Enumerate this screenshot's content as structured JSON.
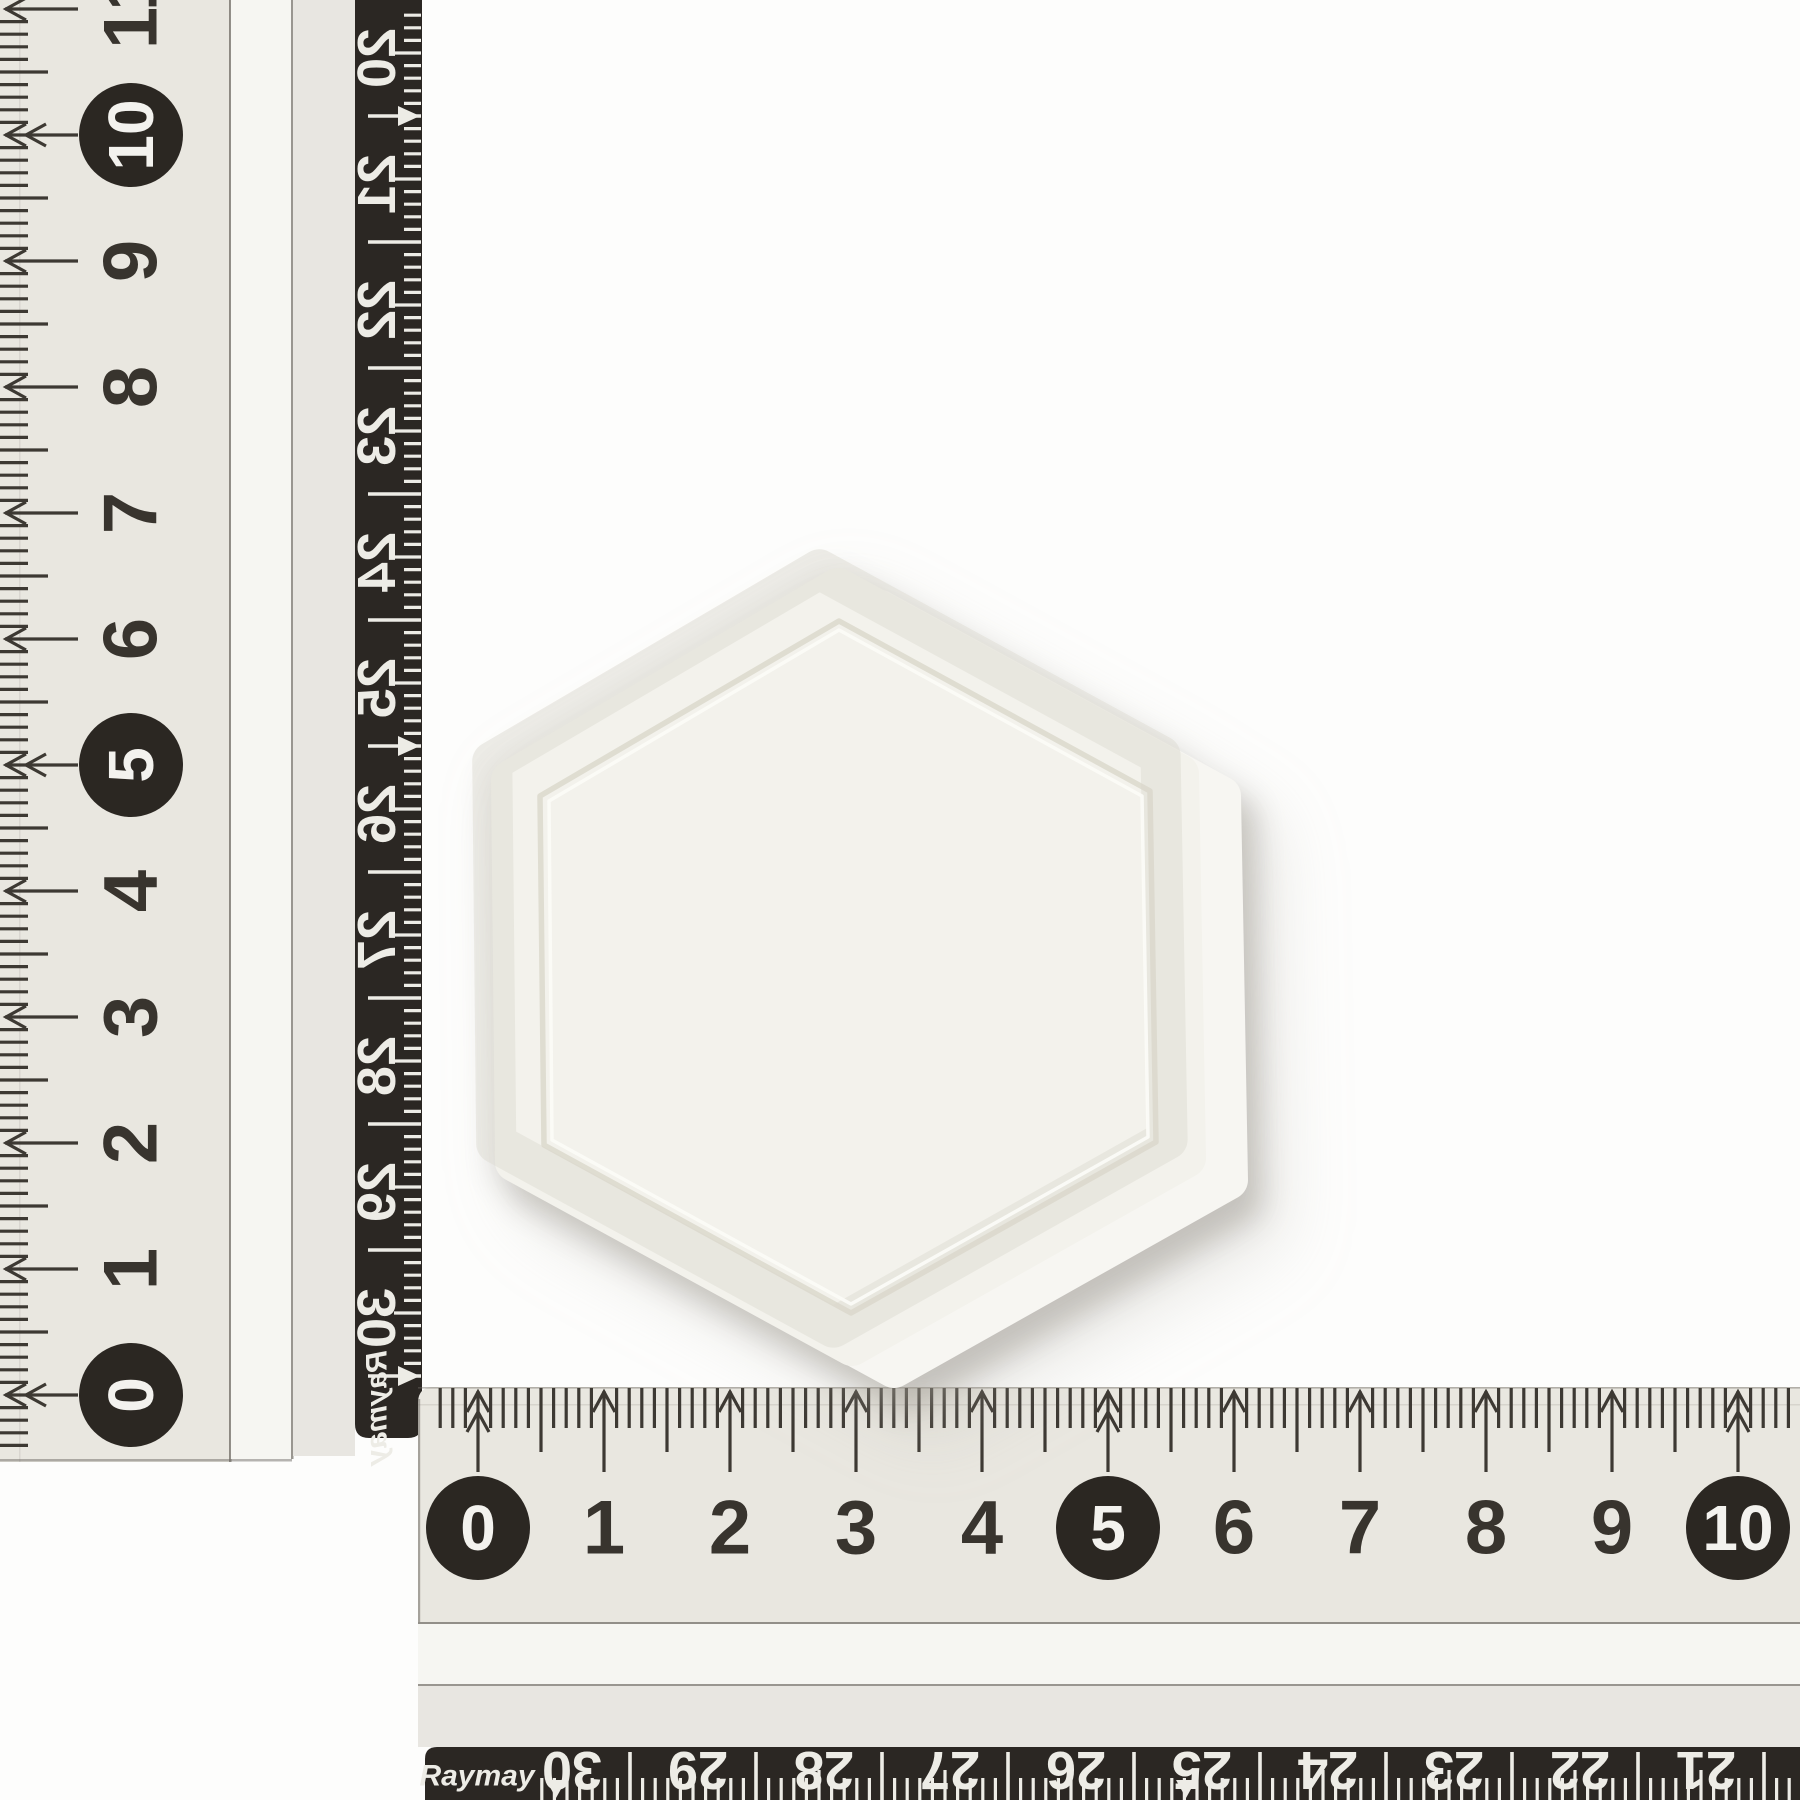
{
  "brand_label": "Raymay",
  "colors": {
    "background": "#fdfdfc",
    "ruler_face": "#e9e7e0",
    "ruler_bevel": "#f6f6f2",
    "ruler_gap": "#e8e6e1",
    "edge_line": "#6e6a63",
    "subtle_line": "#cfccc5",
    "tick": "#3d3933",
    "digit": "#38342e",
    "circle_fill": "#2b2722",
    "circle_digit": "#f3f2ee",
    "strip_fill": "#2b2723",
    "strip_mark": "#edece6",
    "hex_face": "#f3f2ec",
    "hex_side": "#f7f6f2",
    "groove": "#d9d7cb",
    "groove_highlight": "#fbfbf7"
  },
  "vertical_ruler": {
    "front_labels": [
      "0",
      "1",
      "2",
      "3",
      "4",
      "5",
      "6",
      "7",
      "8",
      "9",
      "10",
      "11"
    ],
    "circled_labels": [
      "0",
      "5",
      "10"
    ],
    "back_labels": [
      "20",
      "21",
      "22",
      "23",
      "24",
      "25",
      "26",
      "27",
      "28",
      "29",
      "30"
    ],
    "back_arrow_labels": [
      "20",
      "25",
      "30"
    ],
    "unit_cm_px": 126,
    "origin_y": 1395,
    "mm_min": -4,
    "mm_max": 110,
    "number_x": 131,
    "face": {
      "x": 0,
      "y": 0,
      "w": 230,
      "h": 1462
    },
    "bevel": {
      "x": 231,
      "w": 60,
      "h": 1459
    },
    "gap": {
      "x": 293,
      "w": 62,
      "h": 1456
    },
    "strip": {
      "x": 355,
      "w": 67,
      "h": 1458,
      "corner": 14
    },
    "back_first_tick_y": 116,
    "back_number_offset": -58,
    "logo_pos": {
      "x": 377,
      "y": 1408
    }
  },
  "horizontal_ruler": {
    "front_labels": [
      "0",
      "1",
      "2",
      "3",
      "4",
      "5",
      "6",
      "7",
      "8",
      "9",
      "10"
    ],
    "circled_labels": [
      "0",
      "5",
      "10"
    ],
    "back_labels": [
      "30",
      "29",
      "28",
      "27",
      "26",
      "25",
      "24",
      "23",
      "22",
      "21"
    ],
    "back_arrow_labels": [
      "30",
      "25"
    ],
    "unit_cm_px": 126,
    "origin_x": 478,
    "mm_min": -3,
    "mm_max": 104,
    "number_y": 1528,
    "face": {
      "x": 418,
      "y": 1387,
      "w": 1382,
      "h": 235,
      "corner": 16
    },
    "bevel": {
      "y": 1624,
      "h": 60
    },
    "gap": {
      "y": 1686,
      "h": 61
    },
    "strip": {
      "x": 425,
      "y": 1747,
      "h": 73,
      "corner": 12
    },
    "back_first_tick_x": 630,
    "back_number_offset": -58,
    "back_number_y": 1770,
    "logo_pos": {
      "x": 477,
      "y": 1776
    }
  },
  "hexagon": {
    "outer_pts": [
      [
        838,
        588
      ],
      [
        1179,
        774
      ],
      [
        1186,
        1158
      ],
      [
        852,
        1346
      ],
      [
        515,
        1162
      ],
      [
        511,
        780
      ]
    ],
    "groove_pts": [
      [
        839,
        621
      ],
      [
        1150,
        791
      ],
      [
        1156,
        1142
      ],
      [
        851,
        1313
      ],
      [
        544,
        1145
      ],
      [
        540,
        796
      ]
    ],
    "inner_pts": [
      [
        839,
        630
      ],
      [
        1142,
        796
      ],
      [
        1148,
        1137
      ],
      [
        851,
        1304
      ],
      [
        552,
        1140
      ],
      [
        549,
        801
      ]
    ],
    "side_offset": [
      42,
      22
    ],
    "outline_stroke": 40,
    "groove_stroke": 5.5,
    "highlight_stroke": 3.5
  }
}
